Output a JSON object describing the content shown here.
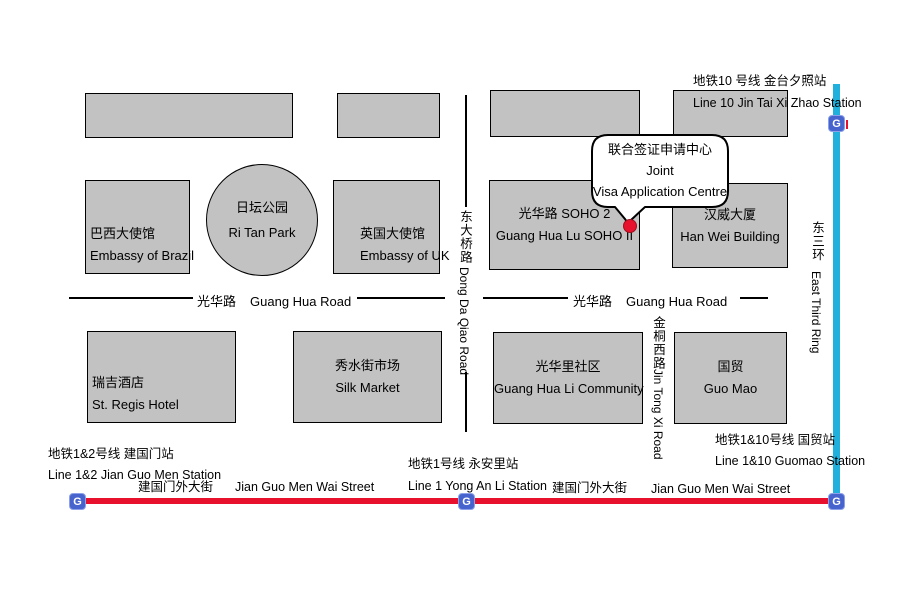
{
  "canvas": {
    "width": 907,
    "height": 605
  },
  "colors": {
    "building_fill": "#c2c2c2",
    "outline": "#000000",
    "metro_line_red": "#e8112d",
    "metro_line_blue": "#1fb0dd",
    "metro_icon_blue": "#4763ce",
    "marker_red": "#e8112d"
  },
  "callout": {
    "zh": "联合签证申请中心",
    "en_line1": "Joint",
    "en_line2": "Visa Application Centre"
  },
  "park": {
    "zh": "日坛公园",
    "en": "Ri Tan Park"
  },
  "buildings": {
    "brazil": {
      "zh": "巴西大使馆",
      "en": "Embassy of Brazil"
    },
    "uk": {
      "zh": "英国大使馆",
      "en": "Embassy of UK"
    },
    "soho": {
      "zh": "光华路 SOHO 2",
      "en": "Guang Hua Lu SOHO II"
    },
    "hanwei": {
      "zh": "汉威大厦",
      "en": "Han Wei Building"
    },
    "stregis": {
      "zh": "瑞吉酒店",
      "en": "St. Regis Hotel"
    },
    "silk": {
      "zh": "秀水街市场",
      "en": "Silk Market"
    },
    "community": {
      "zh": "光华里社区",
      "en": "Guang Hua Li Community"
    },
    "guomao": {
      "zh": "国贸",
      "en": "Guo Mao"
    }
  },
  "roads": {
    "guanghua_west": {
      "zh": "光华路",
      "en": "Guang Hua Road"
    },
    "guanghua_east": {
      "zh": "光华路",
      "en": "Guang Hua Road"
    },
    "dongdaqiao": {
      "zh": "东大桥路",
      "en": "Dong Da Qiao Road"
    },
    "jintongxi": {
      "zh": "金桐西路",
      "en": "Jin Tong Xi Road"
    },
    "east_third_ring": {
      "zh": "东三环",
      "en": "East Third Ring"
    },
    "jianguomenwai_west": {
      "zh": "建国门外大街",
      "en": "Jian Guo Men Wai Street"
    },
    "jianguomenwai_east": {
      "zh": "建国门外大街",
      "en": "Jian Guo Men Wai Street"
    }
  },
  "stations": {
    "jintaixizhao": {
      "zh": "地铁10 号线 金台夕照站",
      "en": "Line 10 Jin Tai Xi Zhao Station"
    },
    "jianguomen": {
      "zh": "地铁1&2号线 建国门站",
      "en": "Line 1&2 Jian Guo Men Station"
    },
    "yonganli": {
      "zh": "地铁1号线 永安里站",
      "en": "Line 1 Yong An Li Station"
    },
    "guomao": {
      "zh": "地铁1&10号线 国贸站",
      "en": "Line 1&10 Guomao Station"
    }
  },
  "metro": {
    "icon_glyph": "G"
  }
}
